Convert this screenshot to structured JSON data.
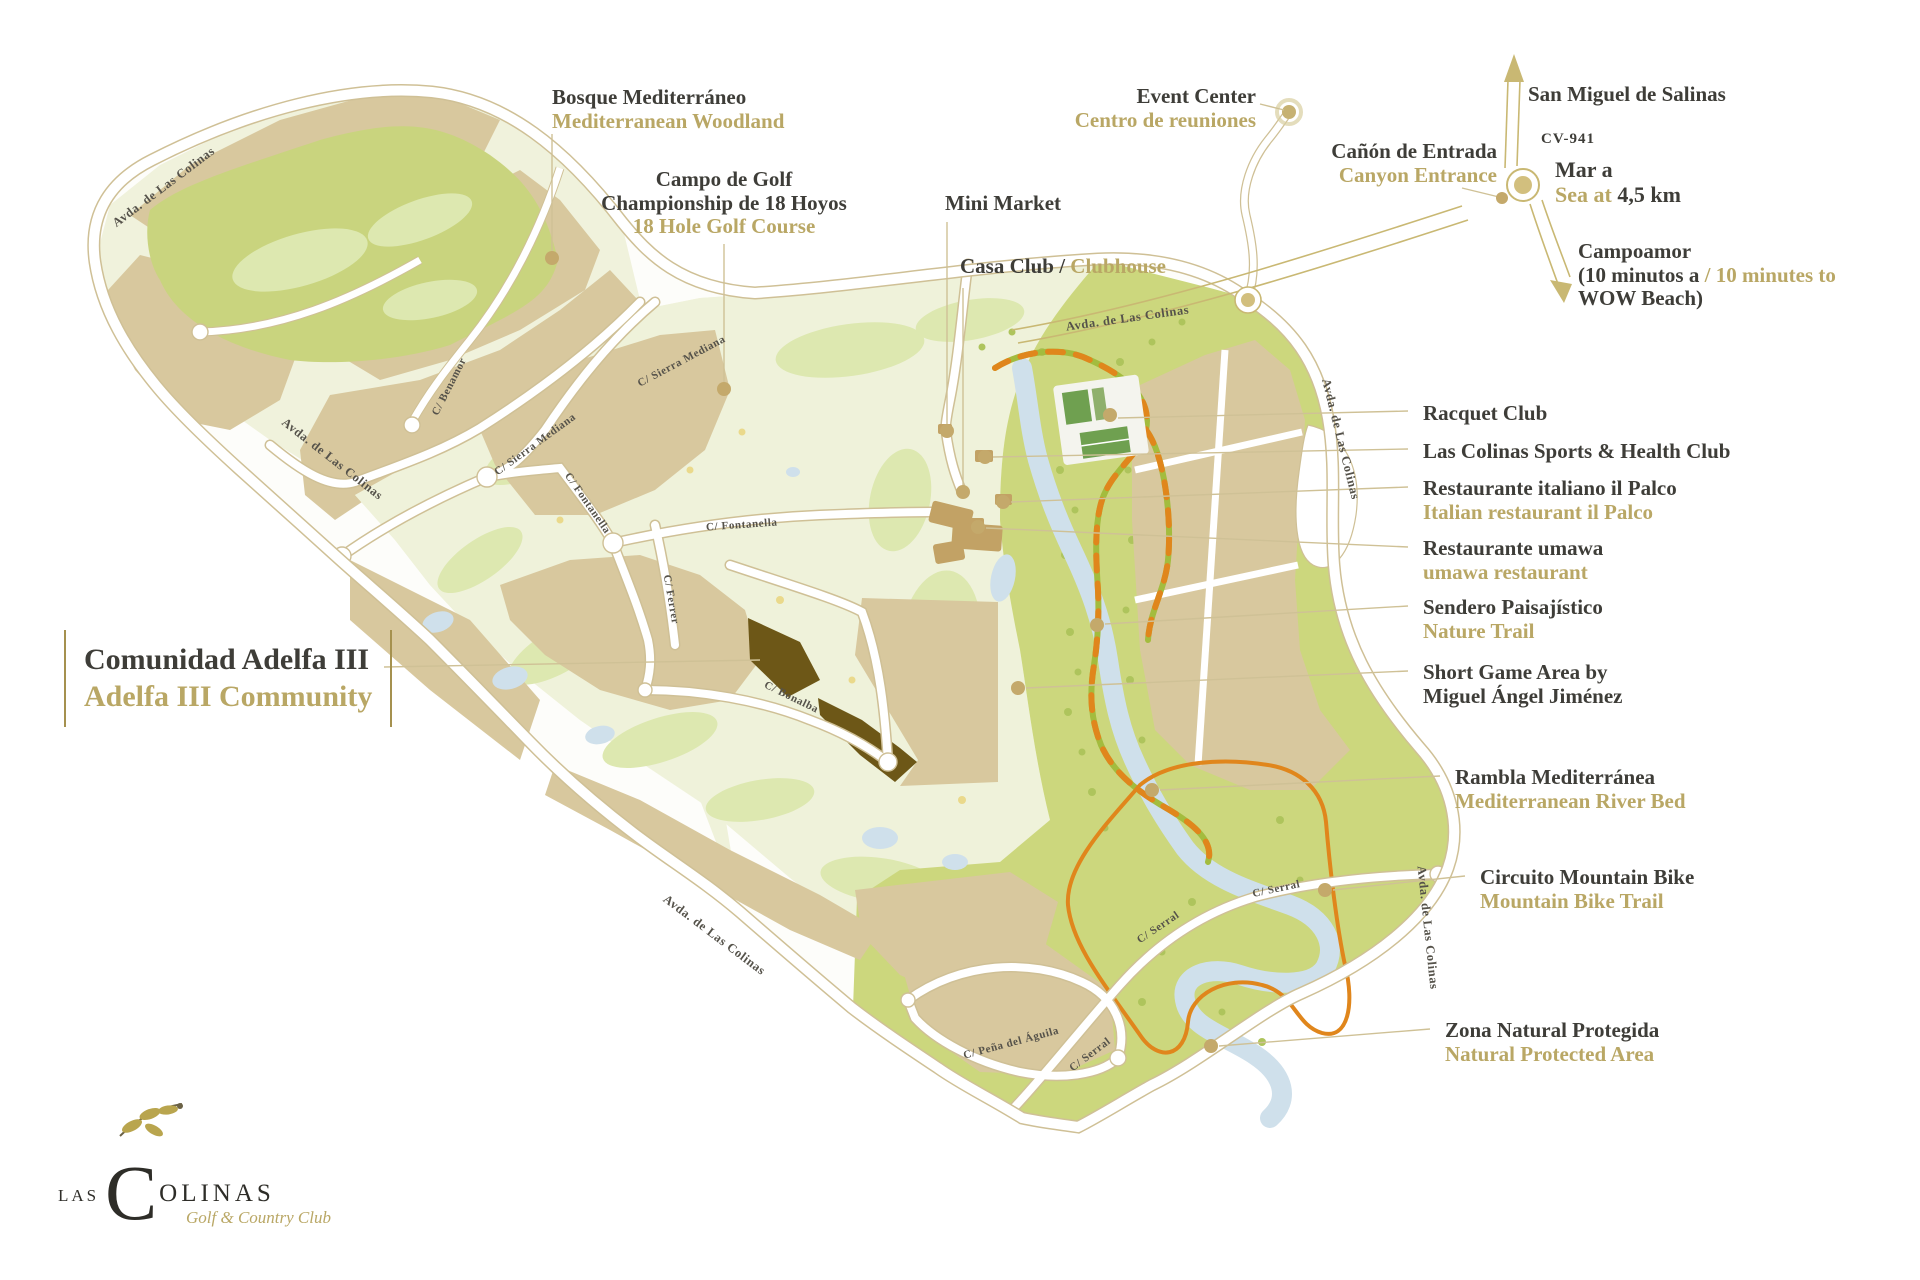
{
  "colors": {
    "label_dark": "#3e3d38",
    "label_gold": "#b9a765",
    "road_gold": "#cfc096",
    "parcel_tan": "#d8c89e",
    "golf_light": "#eff2da",
    "golf_green": "#c9d47e",
    "nature_green": "#ccd77d",
    "adelfa_brown": "#6d5717",
    "river_blue": "#cfe0eb",
    "trail_orange": "#e0861c",
    "trail_green": "#a3bc3e"
  },
  "poi": {
    "bosque": {
      "title": "Bosque Mediterráneo",
      "subtitle": "Mediterranean Woodland"
    },
    "campo": {
      "title": "Campo de Golf",
      "line2": "Championship de 18 Hoyos",
      "subtitle": "18 Hole Golf Course"
    },
    "mini_market": {
      "title": "Mini Market"
    },
    "casa_club": {
      "title": "Casa Club / ",
      "subtitle": "Clubhouse"
    },
    "event_center": {
      "title": "Event Center",
      "subtitle": "Centro de reuniones"
    },
    "canyon_entrance": {
      "title": "Cañón de Entrada",
      "subtitle": "Canyon Entrance"
    },
    "san_miguel": {
      "title": "San Miguel de Salinas"
    },
    "cv941": {
      "title": "CV-941"
    },
    "sea": {
      "title": "Mar a",
      "subtitle_gold": "Sea at ",
      "distance": "4,5 km"
    },
    "campoamor": {
      "title": "Campoamor",
      "line2_black": "(10 minutos a ",
      "line2_gold": "/ 10 minutes to",
      "line3": "WOW Beach)"
    },
    "racquet_club": {
      "title": "Racquet Club"
    },
    "sports_club": {
      "title": "Las Colinas Sports & Health Club"
    },
    "il_palco": {
      "title": "Restaurante italiano il Palco",
      "subtitle": "Italian restaurant il Palco"
    },
    "umawa": {
      "title": "Restaurante umawa",
      "subtitle": "umawa restaurant"
    },
    "sendero": {
      "title": "Sendero Paisajístico",
      "subtitle": "Nature Trail"
    },
    "short_game": {
      "title": "Short Game Area by",
      "line2": "Miguel Ángel Jiménez"
    },
    "rambla": {
      "title": "Rambla Mediterránea",
      "subtitle": "Mediterranean River Bed"
    },
    "mountain_bike": {
      "title": "Circuito Mountain Bike",
      "subtitle": "Mountain Bike Trail"
    },
    "zona_natural": {
      "title": "Zona Natural Protegida",
      "subtitle": "Natural Protected Area"
    },
    "adelfa": {
      "title": "Comunidad Adelfa III",
      "subtitle": "Adelfa III Community"
    }
  },
  "streets": [
    "Avda. de Las Colinas",
    "Avda. de Las Colinas",
    "C/ Benamor",
    "C/ Sierra Mediana",
    "C/ Sierra Mediana",
    "C/ Fontanella",
    "C/ Fontanella",
    "C/ Ferrer",
    "C/ Bonalba",
    "Avda. de Las Colinas",
    "Avda. de Las Colinas",
    "Avda. de Las Colinas",
    "C/ Serral",
    "C/ Serral",
    "C/ Serral",
    "C/ Peña del Águila",
    "Avda. de Las Colinas"
  ],
  "logo": {
    "word_start": "LAS",
    "initial": "C",
    "word_end": "OLINAS",
    "subtitle": "Golf & Country Club"
  }
}
